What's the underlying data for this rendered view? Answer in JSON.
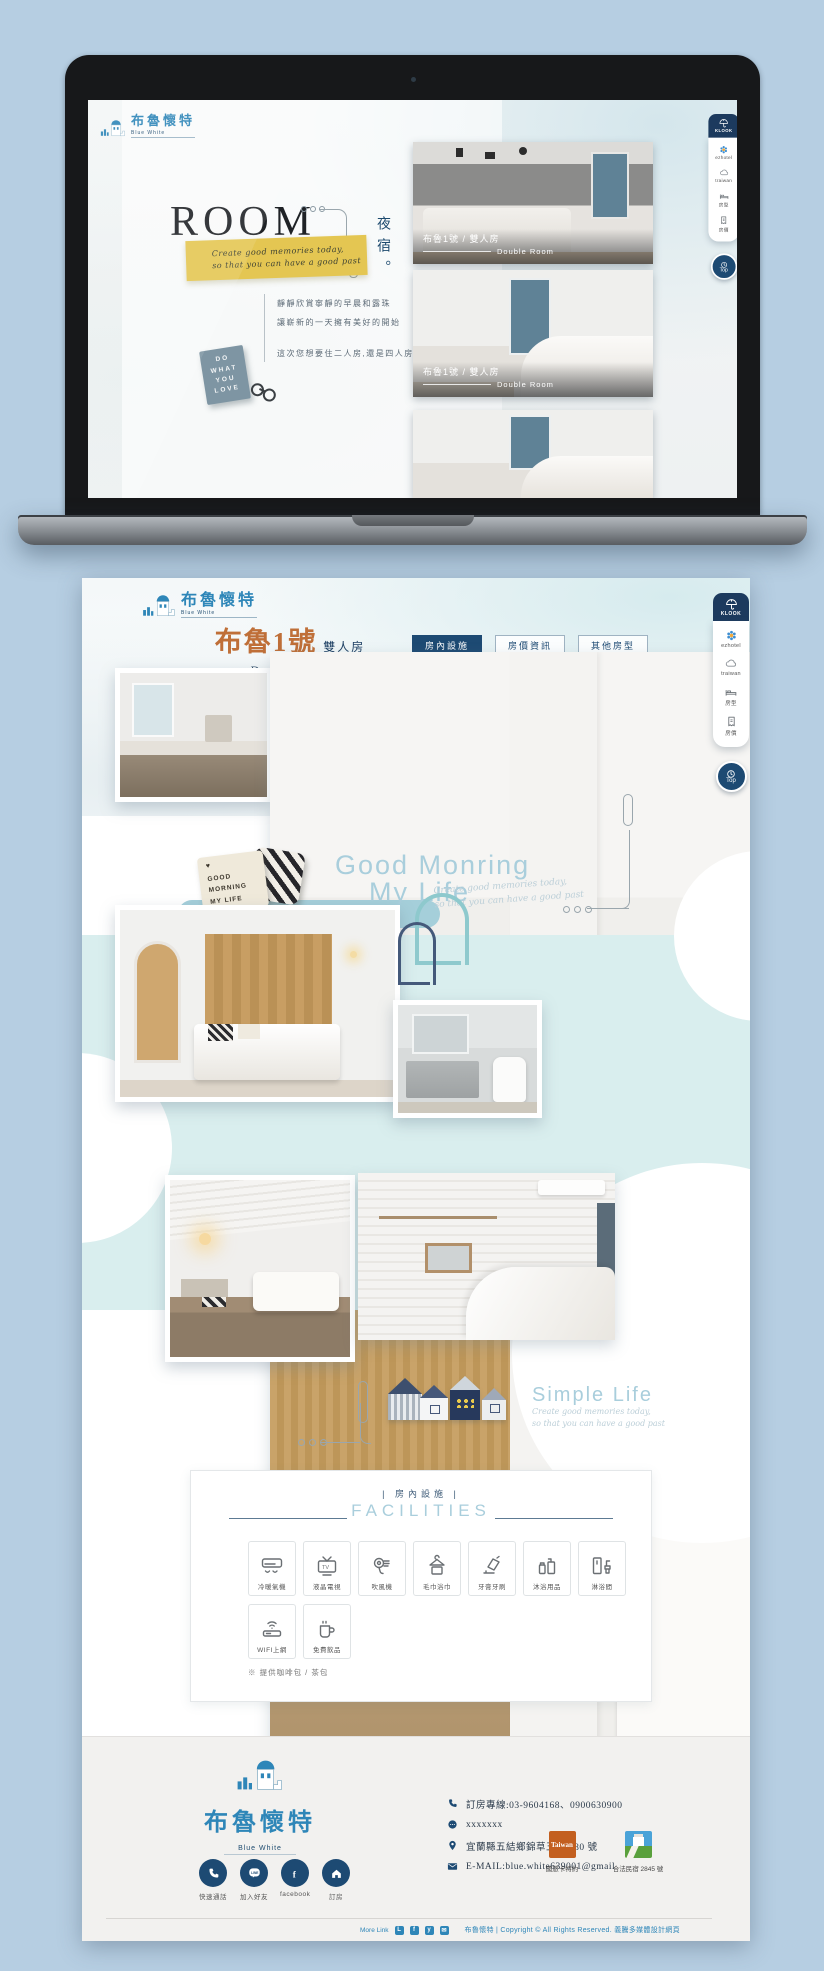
{
  "brand": {
    "name_zh": "布魯懷特",
    "name_en": "Blue White"
  },
  "booking_sidebar": {
    "tab_label": "KLOOK",
    "items": [
      {
        "label": "ezhotel",
        "icon": "flower-icon"
      },
      {
        "label": "traiwan",
        "icon": "cloud-icon"
      },
      {
        "label": "房型",
        "icon": "bed-icon"
      },
      {
        "label": "房價",
        "icon": "price-tag-icon"
      }
    ],
    "top_label": "Top"
  },
  "laptop_page": {
    "hero_title": "ROOM",
    "vertical_label": "夜宿",
    "vertical_punct": "。",
    "banner_script": [
      "Create good memories today,",
      "so that you can have a good past"
    ],
    "intro_lines": [
      "靜靜欣賞寧靜的早晨和露珠",
      "讓嶄新的一天擁有美好的開始"
    ],
    "intro_question": "這次您想要住二人房,還是四人房呢?",
    "sign_lines": [
      "DO",
      "WHAT",
      "YOU",
      "LOVE"
    ],
    "room_cards": [
      {
        "title": "布魯1號 / 雙人房",
        "subtitle": "Double Room"
      },
      {
        "title": "布魯1號 / 雙人房",
        "subtitle": "Double Room"
      }
    ]
  },
  "detail_page": {
    "room_title": "布魯1號",
    "room_type": "雙人房",
    "room_title_en": "Double Room",
    "nav_buttons": [
      {
        "label": "房內設施"
      },
      {
        "label": "房價資訊"
      },
      {
        "label": "其他房型"
      }
    ],
    "pillow_lines": [
      "GOOD",
      "MORNING",
      "MY LIFE"
    ],
    "pillow_heart": "♥",
    "morning": {
      "heading_line1": "Good Monring",
      "heading_line2": "My Life",
      "script_line1": "Create good memories today,",
      "script_line2": "so that you can have a good past"
    },
    "simple": {
      "heading": "Simple Life",
      "script_line1": "Create good memories today,",
      "script_line2": "so that you can have a good past"
    },
    "facilities": {
      "heading_zh": "| 房內設施 |",
      "heading_en": "FACILITIES",
      "items": [
        {
          "label": "冷暖氣機",
          "icon": "air-conditioner-icon"
        },
        {
          "label": "液晶電視",
          "icon": "tv-icon"
        },
        {
          "label": "吹風機",
          "icon": "hair-dryer-icon"
        },
        {
          "label": "毛巾浴巾",
          "icon": "towel-hanger-icon"
        },
        {
          "label": "牙膏牙刷",
          "icon": "toothbrush-icon"
        },
        {
          "label": "沐浴用品",
          "icon": "bath-supplies-icon"
        },
        {
          "label": "淋浴間",
          "icon": "shower-icon"
        },
        {
          "label": "WIFI上網",
          "icon": "wifi-router-icon"
        },
        {
          "label": "免費飲品",
          "icon": "free-drinks-icon"
        }
      ],
      "note": "※ 提供咖啡包 / 茶包"
    }
  },
  "footer": {
    "social": [
      {
        "label": "快速通話",
        "icon": "phone-icon"
      },
      {
        "label": "加入好友",
        "icon": "line-app-icon"
      },
      {
        "label": "facebook",
        "icon": "facebook-icon"
      },
      {
        "label": "訂房",
        "icon": "booking-home-icon"
      }
    ],
    "contact": [
      {
        "icon": "phone-icon",
        "text": "訂房專線:03-9604168、0900630900"
      },
      {
        "icon": "chat-icon",
        "text": "xxxxxxx"
      },
      {
        "icon": "map-pin-icon",
        "text": "宜蘭縣五結鄉錦草五路 180 號"
      },
      {
        "icon": "email-icon",
        "text": "E-MAIL:blue.white639001@gmail"
      }
    ],
    "certifications": [
      {
        "logo_text": "Taiwan",
        "label": "國旅卡特約"
      },
      {
        "logo_text": "",
        "label": "合法民宿 2845 號"
      }
    ],
    "bottom": {
      "more_label": "More Link",
      "line_badge": "L",
      "fb_badge": "f",
      "tw_badge": "y",
      "mail_badge": "✉",
      "copyright": "布魯懷特 | Copyright © All Rights Reserved. 義騰多媒體設計網頁"
    }
  }
}
